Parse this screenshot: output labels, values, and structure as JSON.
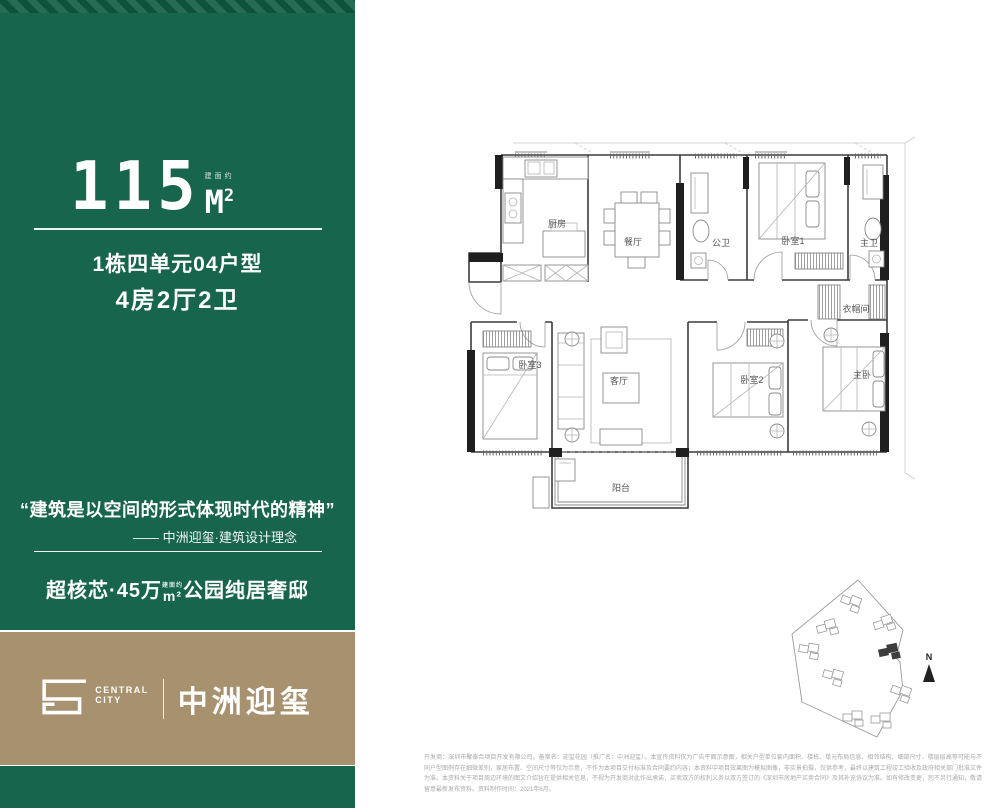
{
  "panel": {
    "area_value": "115",
    "area_note": "建面约",
    "area_unit_letter": "M",
    "area_unit_sup": "2",
    "unit_line": "1栋四单元04户型",
    "layout_line": "4房2厅2卫",
    "quote": "“建筑是以空间的形式体现时代的精神”",
    "quote_attribution": "—— 中洲迎玺·建筑设计理念",
    "tagline_prefix": "超核芯·45万",
    "tagline_unit_note": "建面约",
    "tagline_unit": "m²",
    "tagline_suffix": "公园纯居奢邸"
  },
  "brand": {
    "logo_sub_top": "CENTRAL",
    "logo_sub_bottom": "CITY",
    "name": "中洲迎玺"
  },
  "floorplan": {
    "rooms": [
      {
        "label": "厨房"
      },
      {
        "label": "餐厅"
      },
      {
        "label": "公卫"
      },
      {
        "label": "卧室1"
      },
      {
        "label": "主卫"
      },
      {
        "label": "衣帽间"
      },
      {
        "label": "卧室3"
      },
      {
        "label": "客厅"
      },
      {
        "label": "卧室2"
      },
      {
        "label": "主卧"
      },
      {
        "label": "阳台"
      }
    ],
    "compass_label": "N"
  },
  "colors": {
    "panel_green": "#16654c",
    "band_gold": "#a8916e",
    "wall_black": "#1f1f1f"
  },
  "disclaimer": "开发商：深圳市聚泰合项目开发有限公司。备案名：迎玺花园（推广名：中洲迎玺）。本宣传资料仅为广告平面示意图，相关户型单位套内面积、楼栋、单元布局信息、相邻结构、细部尺寸、楼层层高等可能与不同户型图例存在细微差别，家居布置、空间尺寸等仅为示意，不作为本项目交付标准及合同要约内容；本资料中项目效果图为模拟图像，非实景拍摄，仅供参考，最终以建筑工程竣工验收及政府相关部门批准文件为准。本资料关于项目周边环境的图文介绍旨在提供相关信息，不视为开发商对此作出承诺，买卖双方的权利义务以双方签订的《深圳市房地产买卖合同》及其补充协议为准。如有修改变更，恕不另行通知，敬请留意最新发布资料。资料制作时间：2021年6月。"
}
